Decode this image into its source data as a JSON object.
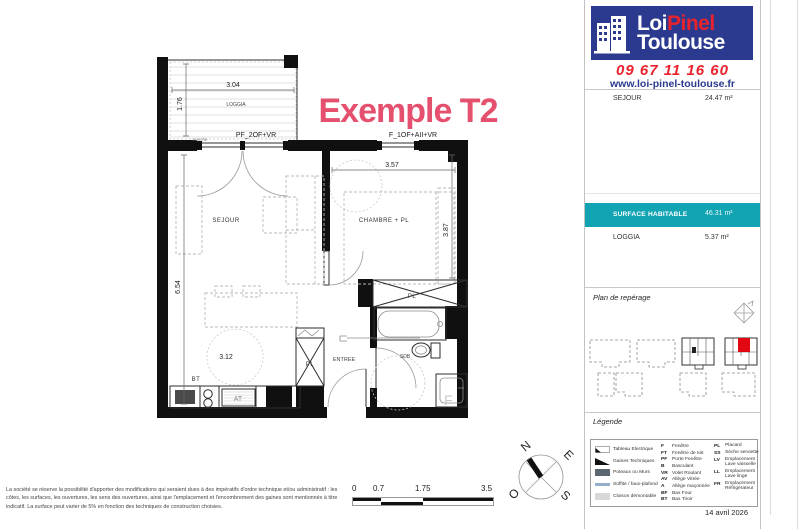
{
  "branding": {
    "logo": {
      "word1": "Loi",
      "word2": "Pinel",
      "word3": "Toulouse"
    },
    "phone": "09 67 11 16 60",
    "website": "www.loi-pinel-toulouse.fr"
  },
  "colors": {
    "logo_blue": "#2b3a8e",
    "brand_red": "#e8232e",
    "teal_highlight": "#13a4b4",
    "plan_title_pink": "#e5506e",
    "wall_black": "#101010",
    "legend_wall_gray": "#5c6670",
    "legend_soffit_blue": "#92aecb",
    "reperage_unit_red": "#e30613"
  },
  "surface_table": {
    "rows": [
      {
        "label": "SEJOUR",
        "value": "24.47 m²"
      }
    ],
    "highlight": {
      "label": "SURFACE HABITABLE",
      "value": "46.31 m²"
    },
    "rows_after": [
      {
        "label": "LOGGIA",
        "value": "5.37 m²"
      }
    ]
  },
  "reperage": {
    "title": "Plan de repérage"
  },
  "legend": {
    "title": "Légende",
    "materials": [
      {
        "label": "Tableau Electrique"
      },
      {
        "label": "Gaines Techniques"
      },
      {
        "label": "Poteaux ou Murs"
      },
      {
        "label": "Soffite / faux-plafond"
      },
      {
        "label": "Cloison démontable"
      }
    ],
    "abbr1": [
      {
        "key": "F",
        "label": "Fenêtre"
      },
      {
        "key": "FT",
        "label": "Fenêtre de toit"
      },
      {
        "key": "PF",
        "label": "Porte Fenêtre"
      },
      {
        "key": "B",
        "label": "Basculant"
      },
      {
        "key": "VR",
        "label": "Volet Roulant"
      },
      {
        "key": "AV",
        "label": "Allège Vitrée"
      },
      {
        "key": "A",
        "label": "Allège maçonnée"
      },
      {
        "key": "BF",
        "label": "Bas Four"
      },
      {
        "key": "BT",
        "label": "Bas Tiroir"
      }
    ],
    "abbr2": [
      {
        "key": "PL",
        "label": "Placard"
      },
      {
        "key": "SS",
        "label": "Sèche serviette"
      },
      {
        "key": "LV",
        "label": "Emplacement Lave vaisselle"
      },
      {
        "key": "LL",
        "label": "Emplacement Lave linge"
      },
      {
        "key": "FR",
        "label": "Emplacement Réfrigérateur"
      }
    ]
  },
  "date": "14 avril 2026",
  "plan": {
    "title": "Exemple T2",
    "loggia": {
      "label": "LOGGIA",
      "dim_w": "3.04",
      "dim_h": "1.76",
      "door_code": "PF_2OF+VR",
      "step": "marche"
    },
    "window_code": "F_1OF+AII+VR",
    "rooms": {
      "sejour": "SEJOUR",
      "chambre": "CHAMBRE + PL",
      "entree": "ENTREE",
      "sdb": "SDB",
      "placard_chambre": "PL",
      "placard_entree": "PL"
    },
    "dims": {
      "chambre_w": "3.57",
      "chambre_h": "3.87",
      "sejour_h": "6.54",
      "sejour_w": "3.12"
    },
    "kitchen": {
      "bt": "BT",
      "at": "AT"
    },
    "sdb_f": "F"
  },
  "scalebar": {
    "t0": "0",
    "t1": "0.7",
    "t2": "1.75",
    "t3": "3.5"
  },
  "compass": {
    "n": "N",
    "e": "E",
    "s": "S",
    "o": "O"
  },
  "disclaimer": "La société se réserve la possibilité d'apporter des modifications qui seraient dues à des impératifs d'ordre technique et/ou administratif : les côtes, les surfaces, les ouvertures, les sens des ouvertures, ainsi que l'emplacement et l'encombrement des gaines sont mentionnés à titre indicatif. La surface peut varier de 5% en fonction des techniques de construction choisies."
}
